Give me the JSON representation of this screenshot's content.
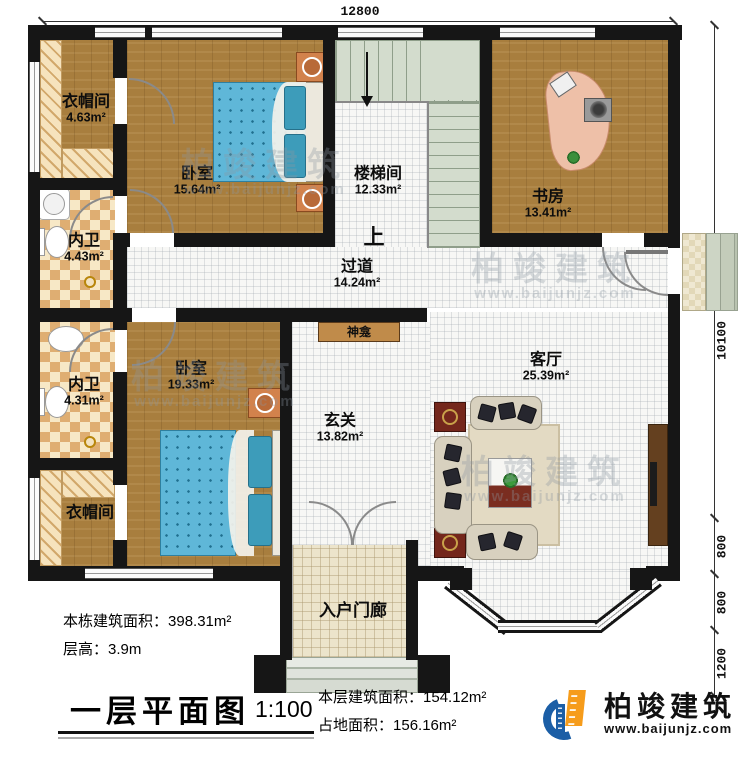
{
  "rooms": {
    "cloakroom_top": {
      "name": "衣帽间",
      "area": "4.63m²"
    },
    "bedroom_top": {
      "name": "卧室",
      "area": "15.64m²"
    },
    "stairwell": {
      "name": "楼梯间",
      "area": "12.33m²"
    },
    "study": {
      "name": "书房",
      "area": "13.41m²"
    },
    "bath_top": {
      "name": "内卫",
      "area": "4.43m²"
    },
    "hallway": {
      "name": "过道",
      "area": "14.24m²"
    },
    "bath_bottom": {
      "name": "内卫",
      "area": "4.31m²"
    },
    "bedroom_bottom": {
      "name": "卧室",
      "area": "19.33m²"
    },
    "cloakroom_bottom": {
      "name": "衣帽间"
    },
    "foyer": {
      "name": "玄关",
      "area": "13.82m²"
    },
    "living_room": {
      "name": "客厅",
      "area": "25.39m²"
    },
    "shrine": {
      "name": "神龛"
    },
    "entry_porch": {
      "name": "入户门廊"
    },
    "stairs_up": "上"
  },
  "dimensions": {
    "top_width": "12800",
    "right_height": "10100",
    "right_seg1": "800",
    "right_seg2": "800",
    "right_seg3": "1200"
  },
  "info": {
    "building_area_label": "本栋建筑面积：",
    "building_area_value": "398.31m²",
    "floor_height_label": "层高：",
    "floor_height_value": "3.9m",
    "plan_title": "一层平面图",
    "scale": "1:100",
    "floor_area_label": "本层建筑面积：",
    "floor_area_value": "154.12m²",
    "land_area_label": "占地面积：",
    "land_area_value": "156.16m²"
  },
  "brand": {
    "name": "柏竣建筑",
    "url": "www.baijunjz.com"
  },
  "watermark": {
    "name": "柏竣建筑",
    "url": "www.baijunjz.com"
  }
}
